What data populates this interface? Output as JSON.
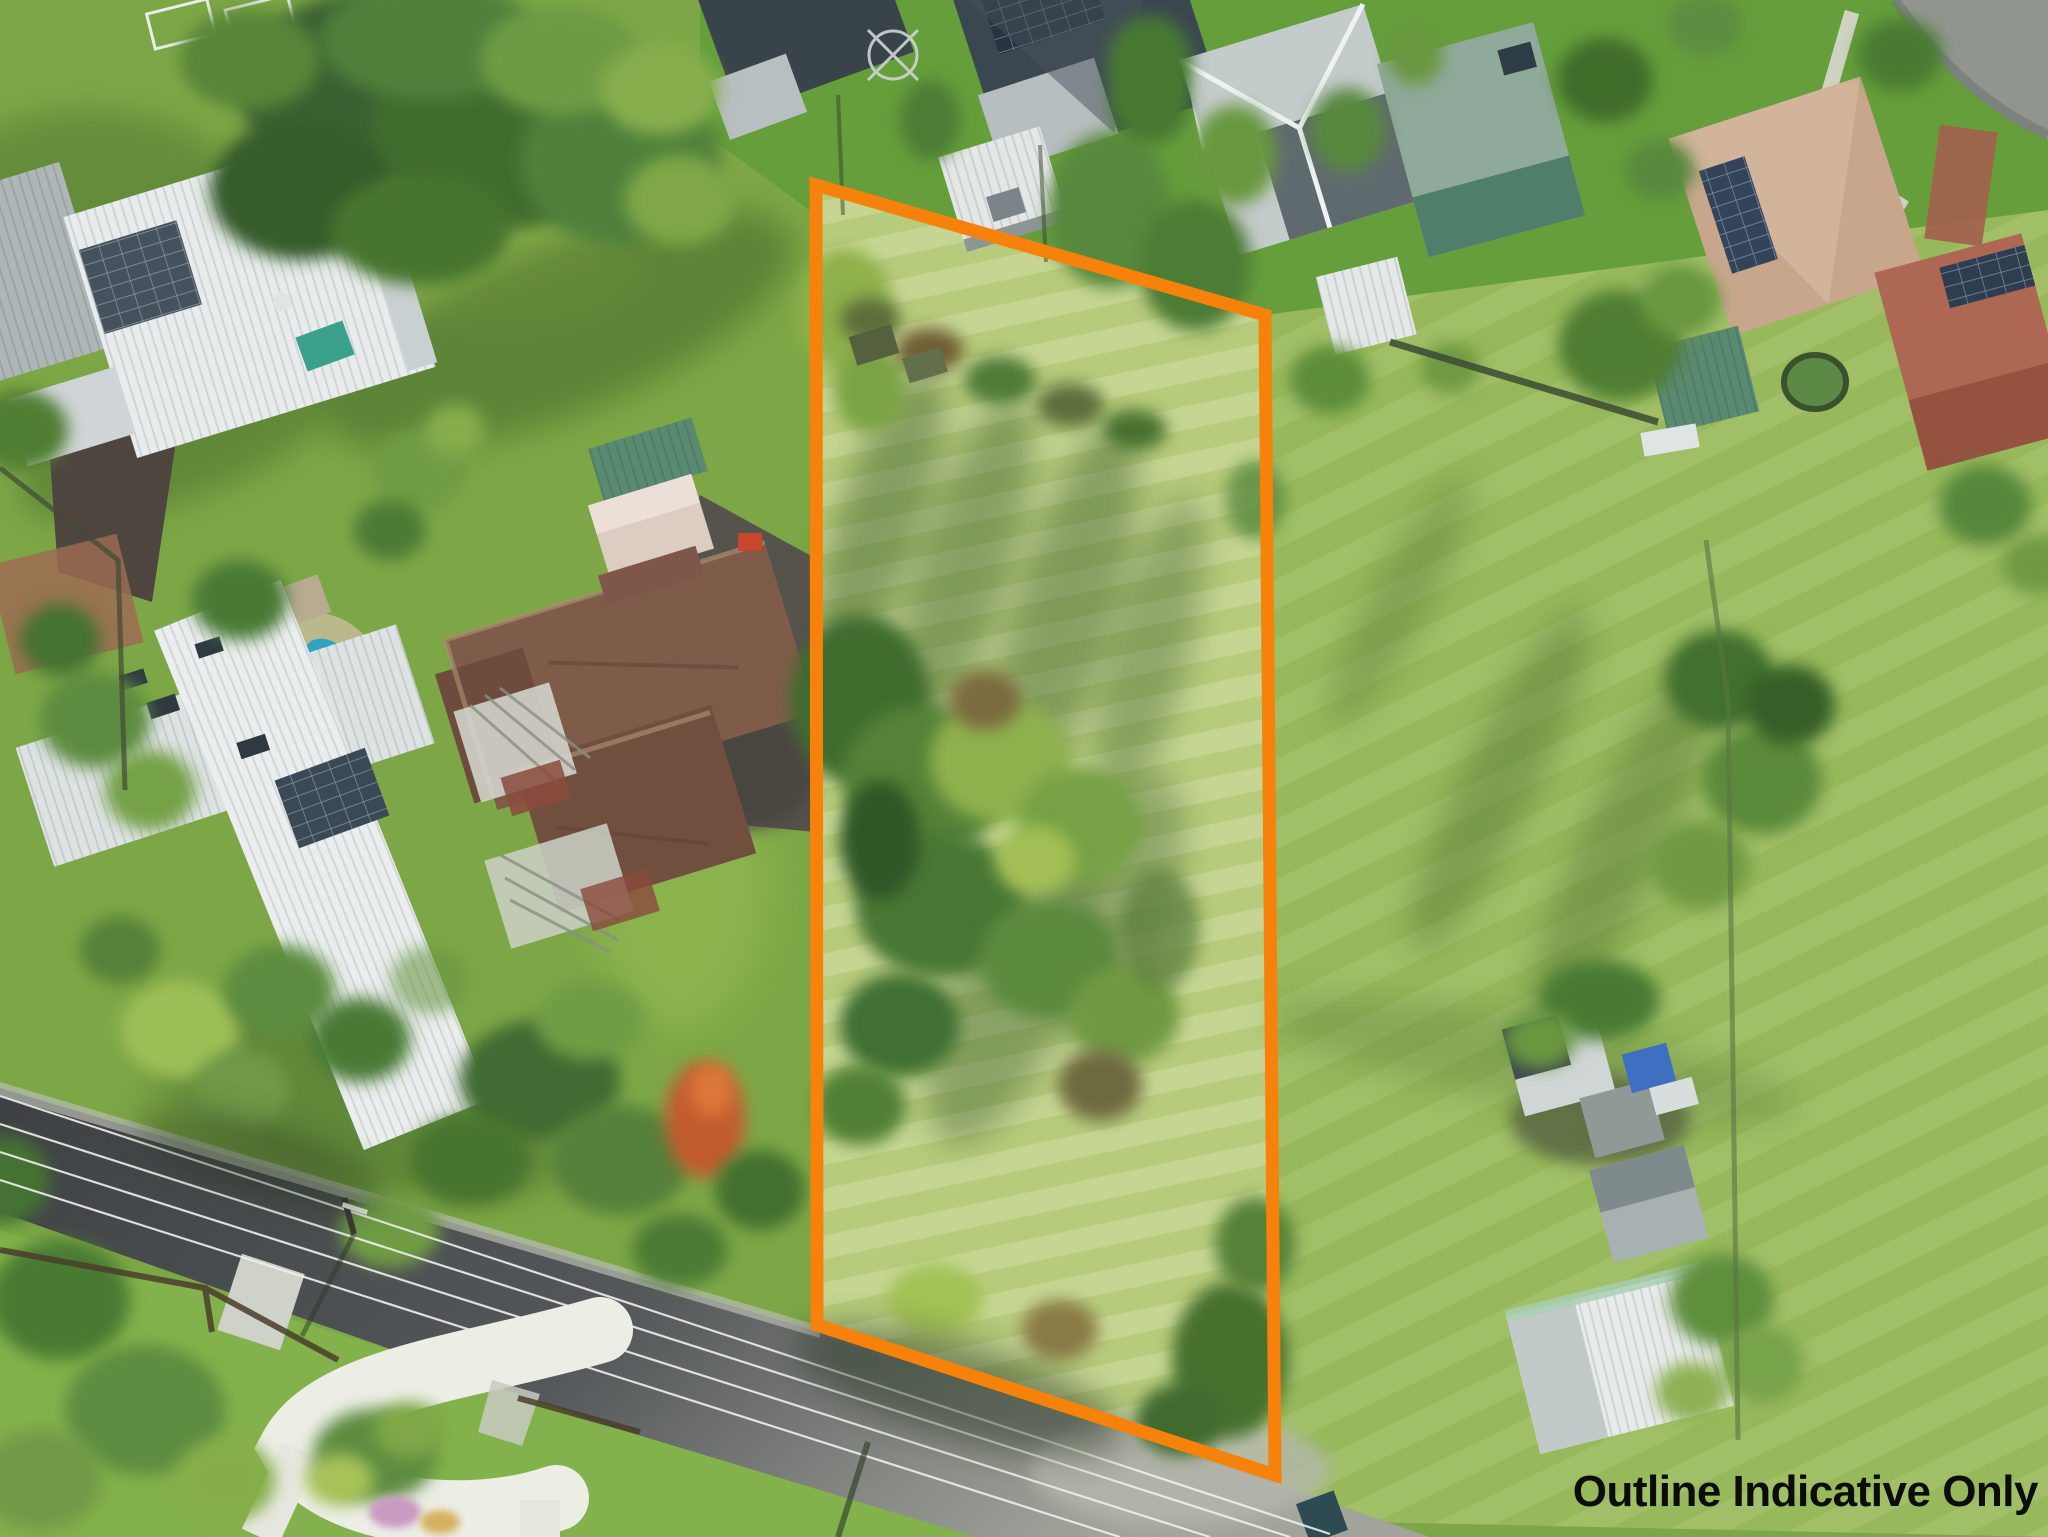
{
  "photo": {
    "type": "aerial-drone-photograph",
    "subject": "residential acreage land parcel with houses, trees, sheds and road"
  },
  "overlay": {
    "annotation": "Outline Indicative Only",
    "annotation_color": "#0c0c0c",
    "outline_color": "#f6820c",
    "outline_stroke_width": "13",
    "outline_points": "816,185 1265,315 1275,1475 817,1325"
  },
  "scene": {
    "features": [
      "boundary-outline",
      "open-grass-parcel",
      "central-tree-thicket",
      "flame-tree",
      "white-metal-roof-houses",
      "brown-tile-roof-house",
      "dark-tile-roof-houses",
      "tan-tile-roof-house",
      "terracotta-roof-houses",
      "green-roof-shed",
      "white-sheds",
      "swimming-pool",
      "solar-panels",
      "asphalt-road",
      "power-lines",
      "concrete-footpath",
      "cul-de-sac",
      "garden-bed",
      "blue-tarp",
      "paddock-fences"
    ]
  },
  "palette": {
    "grass_base": "#7da746",
    "grass_parcel": "#b7cb7c",
    "grass_field": "#97b95b",
    "lawn_dark": "#639d3a",
    "shadow": "#2d5122",
    "road_asphalt": "#44474a",
    "concrete": "#bdbfb6",
    "path_white": "#eceee6",
    "roof_white": "#e8ecec",
    "roof_dark": "#39434a",
    "roof_brown_tile": "#7f5c49",
    "roof_tan": "#c7a68b",
    "roof_terracotta": "#ad6753",
    "roof_green": "#5a8a71",
    "pool_water": "#2fa3bf",
    "solar_panel": "#33435a",
    "tree_dark": "#3f6c2f",
    "tree_light": "#8fb14d",
    "flame_tree": "#c25c2e",
    "tarp_blue": "#3e6fc0"
  }
}
